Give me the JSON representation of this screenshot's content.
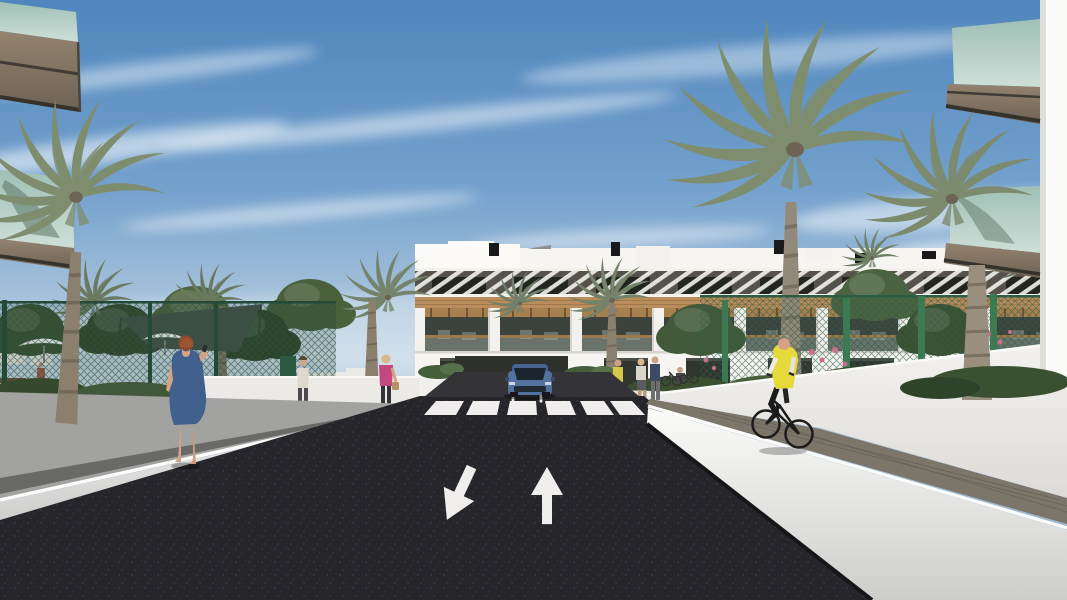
{
  "scene": {
    "type": "3D architectural rendering",
    "setting": "Street view of a modern white residential complex lined with palm trees",
    "sky": "Blue sky with wispy cirrus clouds",
    "road": {
      "surface": "new dark asphalt two-lane street",
      "left_lane_arrow": "arrow pointing toward viewer (down-left)",
      "right_lane_arrow": "arrow pointing away from viewer (up)",
      "crosswalk": "white zebra crosswalk",
      "crosswalk_stripes": 6
    },
    "buildings": {
      "background": "3-storey white apartment block with wood cladding band, slatted pergola sunshades and recessed balconies",
      "foreground_left": "glass balconies with taupe fascia framing the view, top-left",
      "foreground_right": "glass balconies with taupe fascia and white corner wall, top-right"
    },
    "people": {
      "woman_blue_dress": "red-haired woman in a blue dress walking on the left sidewalk",
      "distant_walker": "pedestrian walking away on the left path",
      "woman_pink_top": "blonde woman in a pink top with a handbag",
      "cyclist": "cyclist in a yellow vest riding away on the right walkway",
      "right_group": "small group of residents near the right entrance with parked bicycles"
    },
    "vehicles": {
      "car": "blue car approaching the crosswalk"
    },
    "vegetation": "date palms, leafy trees, hedges and pink flowering shrubs behind green mesh fences"
  },
  "colors": {
    "sky_top": "#4f86bd",
    "sky_mid": "#74a1cd",
    "sky_horizon": "#dce7ee",
    "cloud": "#ffffff",
    "asphalt": "#26262a",
    "road_marking": "#efeeec",
    "building_white": "#f6f5f1",
    "pergola_shadow": "#55524a",
    "wood_band": "#b98e5c",
    "wood_pergola": "#a8804e",
    "window_dark": "#23261f",
    "balcony_interior": "#3c423c",
    "glass_teal": "#9fc0b6",
    "glass_teal_light": "#cfdfd8",
    "fascia_taupe": "#93836f",
    "fascia_dark": "#6e6255",
    "wall_white": "#ececea",
    "sidewalk_left": "#a2a2a0",
    "paver_right": "#7b756a",
    "fence_green": "#2e5c46",
    "fence_post": "#3c7a54",
    "palm_green": "#7f8d6f",
    "palm_green_dark": "#6a7a60",
    "palm_trunk": "#8b7f6e",
    "foliage_mid": "#50663f",
    "foliage_dark": "#36492e",
    "flower_pink": "#c96f8e",
    "shade_sail": "#49524a",
    "umbrella_white": "#f4f4f2",
    "dress_blue": "#41608e",
    "hair_red": "#8e4a2b",
    "skin": "#d7a183",
    "vest_yellow": "#e6d93a",
    "car_blue": "#53719f",
    "car_glass": "#1c2630"
  }
}
